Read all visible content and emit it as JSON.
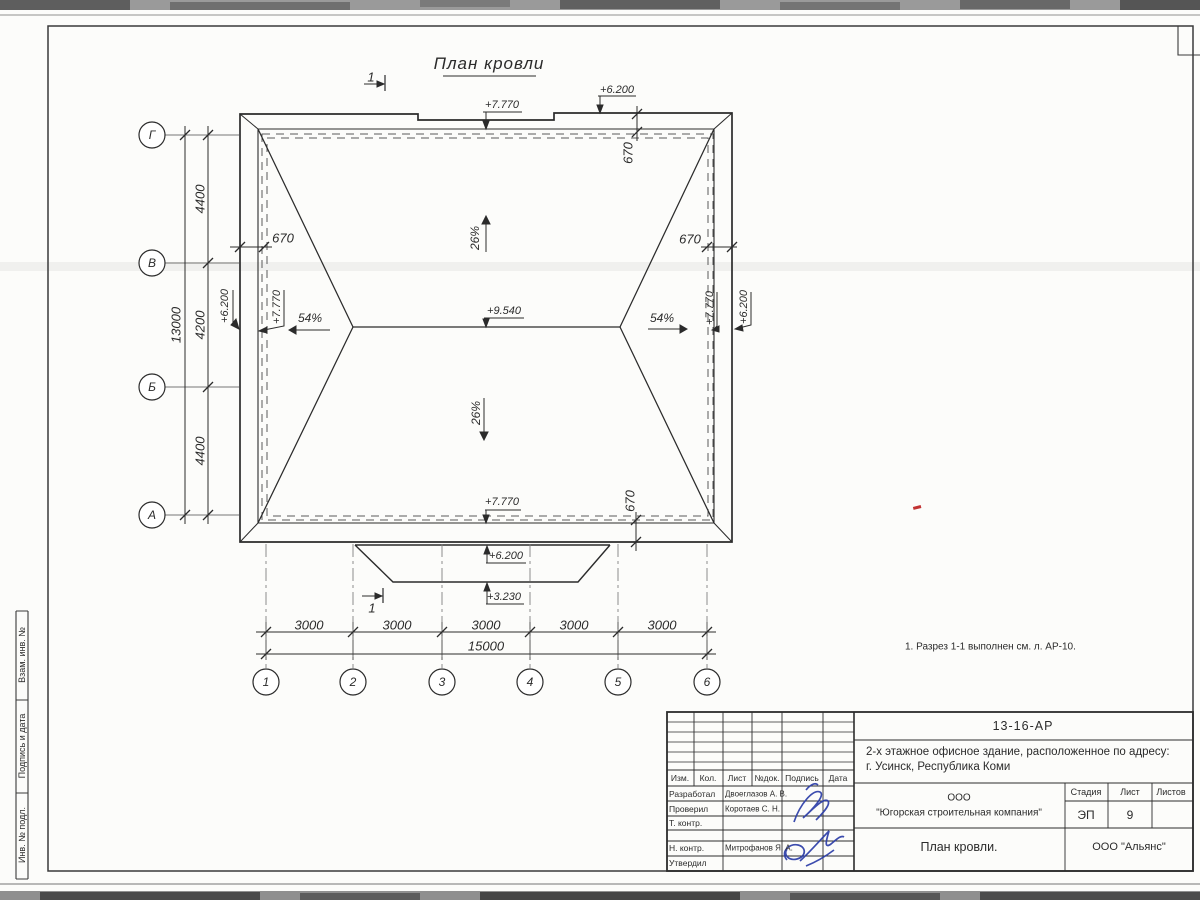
{
  "drawing": {
    "title": "План кровли",
    "note": "1. Разрез 1-1 выполнен см. л. АР-10.",
    "section_label": "1",
    "slope_main": "26%",
    "slope_hip": "54%",
    "overhang": "670",
    "elev_eave": "+7.770",
    "elev_parapet": "+6.200",
    "elev_ridge": "+9.540",
    "elev_canopy_low": "+3.230",
    "dims_bottom": [
      "3000",
      "3000",
      "3000",
      "3000",
      "3000"
    ],
    "dim_bottom_total": "15000",
    "dims_left": [
      "4400",
      "4200",
      "4400"
    ],
    "dim_left_total": "13000",
    "axes_bottom": [
      "1",
      "2",
      "3",
      "4",
      "5",
      "6"
    ],
    "axes_left": [
      "Г",
      "В",
      "Б",
      "А"
    ]
  },
  "titleblock": {
    "doc_number": "13-16-АР",
    "project_line1": "2-х этажное офисное здание, расположенное по адресу:",
    "project_line2": "г. Усинск, Республика Коми",
    "org_line1": "ООО",
    "org_line2": "\"Югорская строительная компания\"",
    "sheet_title": "План кровли.",
    "contractor": "ООО \"Альянс\"",
    "stage_label": "Стадия",
    "sheet_label": "Лист",
    "sheets_label": "Листов",
    "stage_value": "ЭП",
    "sheet_value": "9",
    "col_izm": "Изм.",
    "col_kol": "Кол.",
    "col_list": "Лист",
    "col_doc": "№док.",
    "col_sign": "Подпись",
    "col_date": "Дата",
    "row_developed": "Разработал",
    "row_checked": "Проверил",
    "row_tcontrol": "Т. контр.",
    "row_ncontrol": "Н. контр.",
    "row_approved": "Утвердил",
    "name_developed": "Двоеглазов А. В.",
    "name_checked": "Коротаев С. Н.",
    "name_ncontrol": "Митрофанов Я. А.",
    "signature_color": "#2c3ea8"
  },
  "frame": {
    "side_labels": [
      "Взам. инв. №",
      "Подпись и дата",
      "Инв. № подл."
    ],
    "ink_color": "#2b2b2b"
  }
}
